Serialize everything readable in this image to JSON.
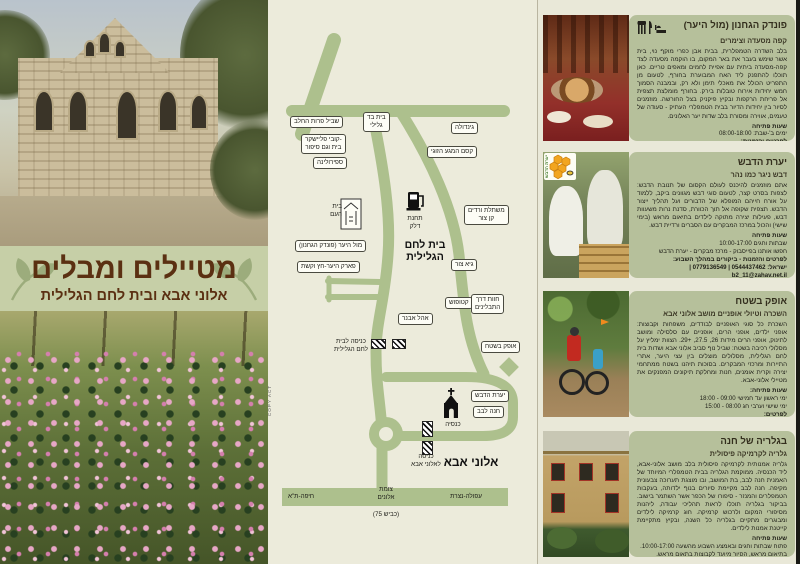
{
  "colors": {
    "page_background": "#e9e8d8",
    "road_olive": "#adc08d",
    "card_green": "#b6c09b",
    "banner_green": "#c6cfa7",
    "banner_brown": "#5b3012"
  },
  "banner": {
    "title": "מטיילים ומבלים",
    "subtitle": "אלוני אבא ובית לחם הגלילית"
  },
  "map": {
    "towns": [
      "בית לחם\nהגלילית",
      "אלוני אבא"
    ],
    "parking": "P",
    "credit": "COPY ACT",
    "labels": [
      "שביל פרות החלב",
      "בית בד\nגלילי",
      "גינדולה",
      "קובי פליישקר-\nבית וגם סיפור",
      "ספירולינה",
      "קסם המגע הזוגי",
      "בית\nהעם",
      "תחנת\nדלק",
      "משתלת ורדים\nקן צור",
      "מול היער (פונדק הגחנון)",
      "פארק היער-חץ וקשת",
      "גיא צור",
      "קטופוש",
      "חוות דרך\nהתבלינים",
      "אהל אבנר",
      "כניסה לבית\nלחם הגלילית",
      "אופק בשטח",
      "יערת הדבש",
      "חנה לבב",
      "כנסיה",
      "כניסה\nלאלוני אבא"
    ],
    "roadlabels": [
      "חיפה-ת\"א",
      "צומת\nאלונים",
      "עפולה-נצרת",
      "(כביש 75)"
    ]
  },
  "listings": [
    {
      "title": "פונדק הגחנון (מול היער)",
      "subtitle": "קפה מסעדה וצימרים",
      "body": "בלב השדרה הטמפלרית, בבית אבן כפרי מוקף נוי, בית אשר שימש בעבר את באר המקום, בו הוקמה מסעדה לצד קפה-מסעדה ביתית עם אפיית לחמים ומאפים טריים. כאן תוכלו להתפנק ליד האח המבוערת בחורף, לטעום מן התפריט הכולל את מאכלי תימן ולא רק, ובמבנה הסמוך חמש יחידות אירוח טובלות בירק. בחורף מומלצת תצפית אל פריחת הרקפות ובקיץ פיקניק בצל החורשה. מוזמנים לסיור בין יחידות הדיור בבית הטמפלרי העתיק - סעודה של טעמים, אווירה ומסורת בלב שדות יער האלונים.",
      "hours_title": "שעות פתיחה",
      "hours_lines": "ימים ב'-שבת: 08:00-18:00",
      "contact_title": "לפרטים והזמנות:",
      "contact_lines": "טל. 04-9832095 | 052-3409152"
    },
    {
      "title": "יערת הדבש",
      "subtitle": "דבש ניגר כמו נהר",
      "logo_text": "יערת הדבש",
      "body": "אתם מוזמנים להיכנס לעולם הקסום של תנובת הדבש: לצפות בסרט קצר, לטעום סוגי דבש מגוונים ביקב, ללמוד על אורח חייהם המופלא של הדבורים ועל תהליך ייצור הדבש. תצפית שקופה אל תוך הכוורת, סדנת נרות משעוות דבש, פעילות יצירה מתוקה לילדים בתיאום מראש (בימי שישי) והכול במרכז המבקרים עם הסברים ורדיית דבש.",
      "hours_title": "שעות פתיחה",
      "hours_lines": "שבתות וחגים 10:00-17:00\nחפשו אותנו בפייסבוק - מרכז מבקרים - יערת הדבש",
      "contact_title": "לפרטים והזמנות - ביקורים במהלך השבוע:",
      "contact_lines": "ישראל: 0544437462 | 0779136549 | b2_11@zahav.net.il"
    },
    {
      "title": "אופק בשטח",
      "subtitle": "השכרה וטיולי אופניים מושב אלוני אבא",
      "body": "השכרת כל סוגי האופניים לבודדים, משפחות וקבוצות: אופני ילדים, אופני הרים, אופניים עם סלסילה ומושב לתינוק, אופני הרים מידות 26, 27.5, +29. הצוות ימליץ על מסלולי רכיבה בשטח: שביל נוף סביב אלוני אבא ושדות בית לחם הגלילית, מסלולים מוצלים בין עצי היער, אתרי התיירות ומרכזי המבקרים. בסוכות תיהנו בשטח ממתחמי יצירה וקרית אומנים, חנות ומחלקת תיקונים המפנקים את מטיילי אלוני-אבא.",
      "hours_title": "שעות פתיחה:",
      "hours_lines": "ימי ראשון עד חמישי 09:00 - 18:00\nימי שישי וערבי חג 08:00 - 15:00",
      "contact_title": "לפרטים:",
      "contact_lines": "0523662181 | לתאום קבוצות והדרכות: 049833987\nOfek@adi.org.il | www.ofek-il.com"
    },
    {
      "title": "בגלריה של חנה",
      "subtitle": "גלריה לקרמיקה פיסולית",
      "body": "גלריה אמנותית לקרמיקה פיסולית בלב מושב אלוני-אבא, ליד הכנסיה. ממוקמת הגלריה בבית הטמפלרי המיוחד של האמנית חנה לבב, בת המושב, ובו מוצגת תערוכה צבעונית מקיפה. חנה לבב מקיימת סיורים בנוף ילדותה, בעקבות הטמפלרים והמנזר - סיפורו של הכפר אשר השתמר בישוב. בביקור בגלריה תוכלו לראות תהליכי עבודה, ליהנות מסיפורי המקום ולרכוש קרמיקה. חוג קרמיקה לילדים ומבוגרים מתקיים בגלריה כל השנה, ובקיץ מתקיימת קייטנת אמנות לילדים.",
      "hours_title": "שעות פתיחה",
      "hours_lines": "פתוח שבתות וחגים ובאמצע השבוע מהשעה 10:00-17:00.\nבתיאום מראש, הסיור מיועד לקבוצות בתאום מראש.",
      "contact_title": "לפרטים:",
      "contact_lines": "www.alonei-aba.co.il | 0544766016 | 049835412"
    }
  ]
}
